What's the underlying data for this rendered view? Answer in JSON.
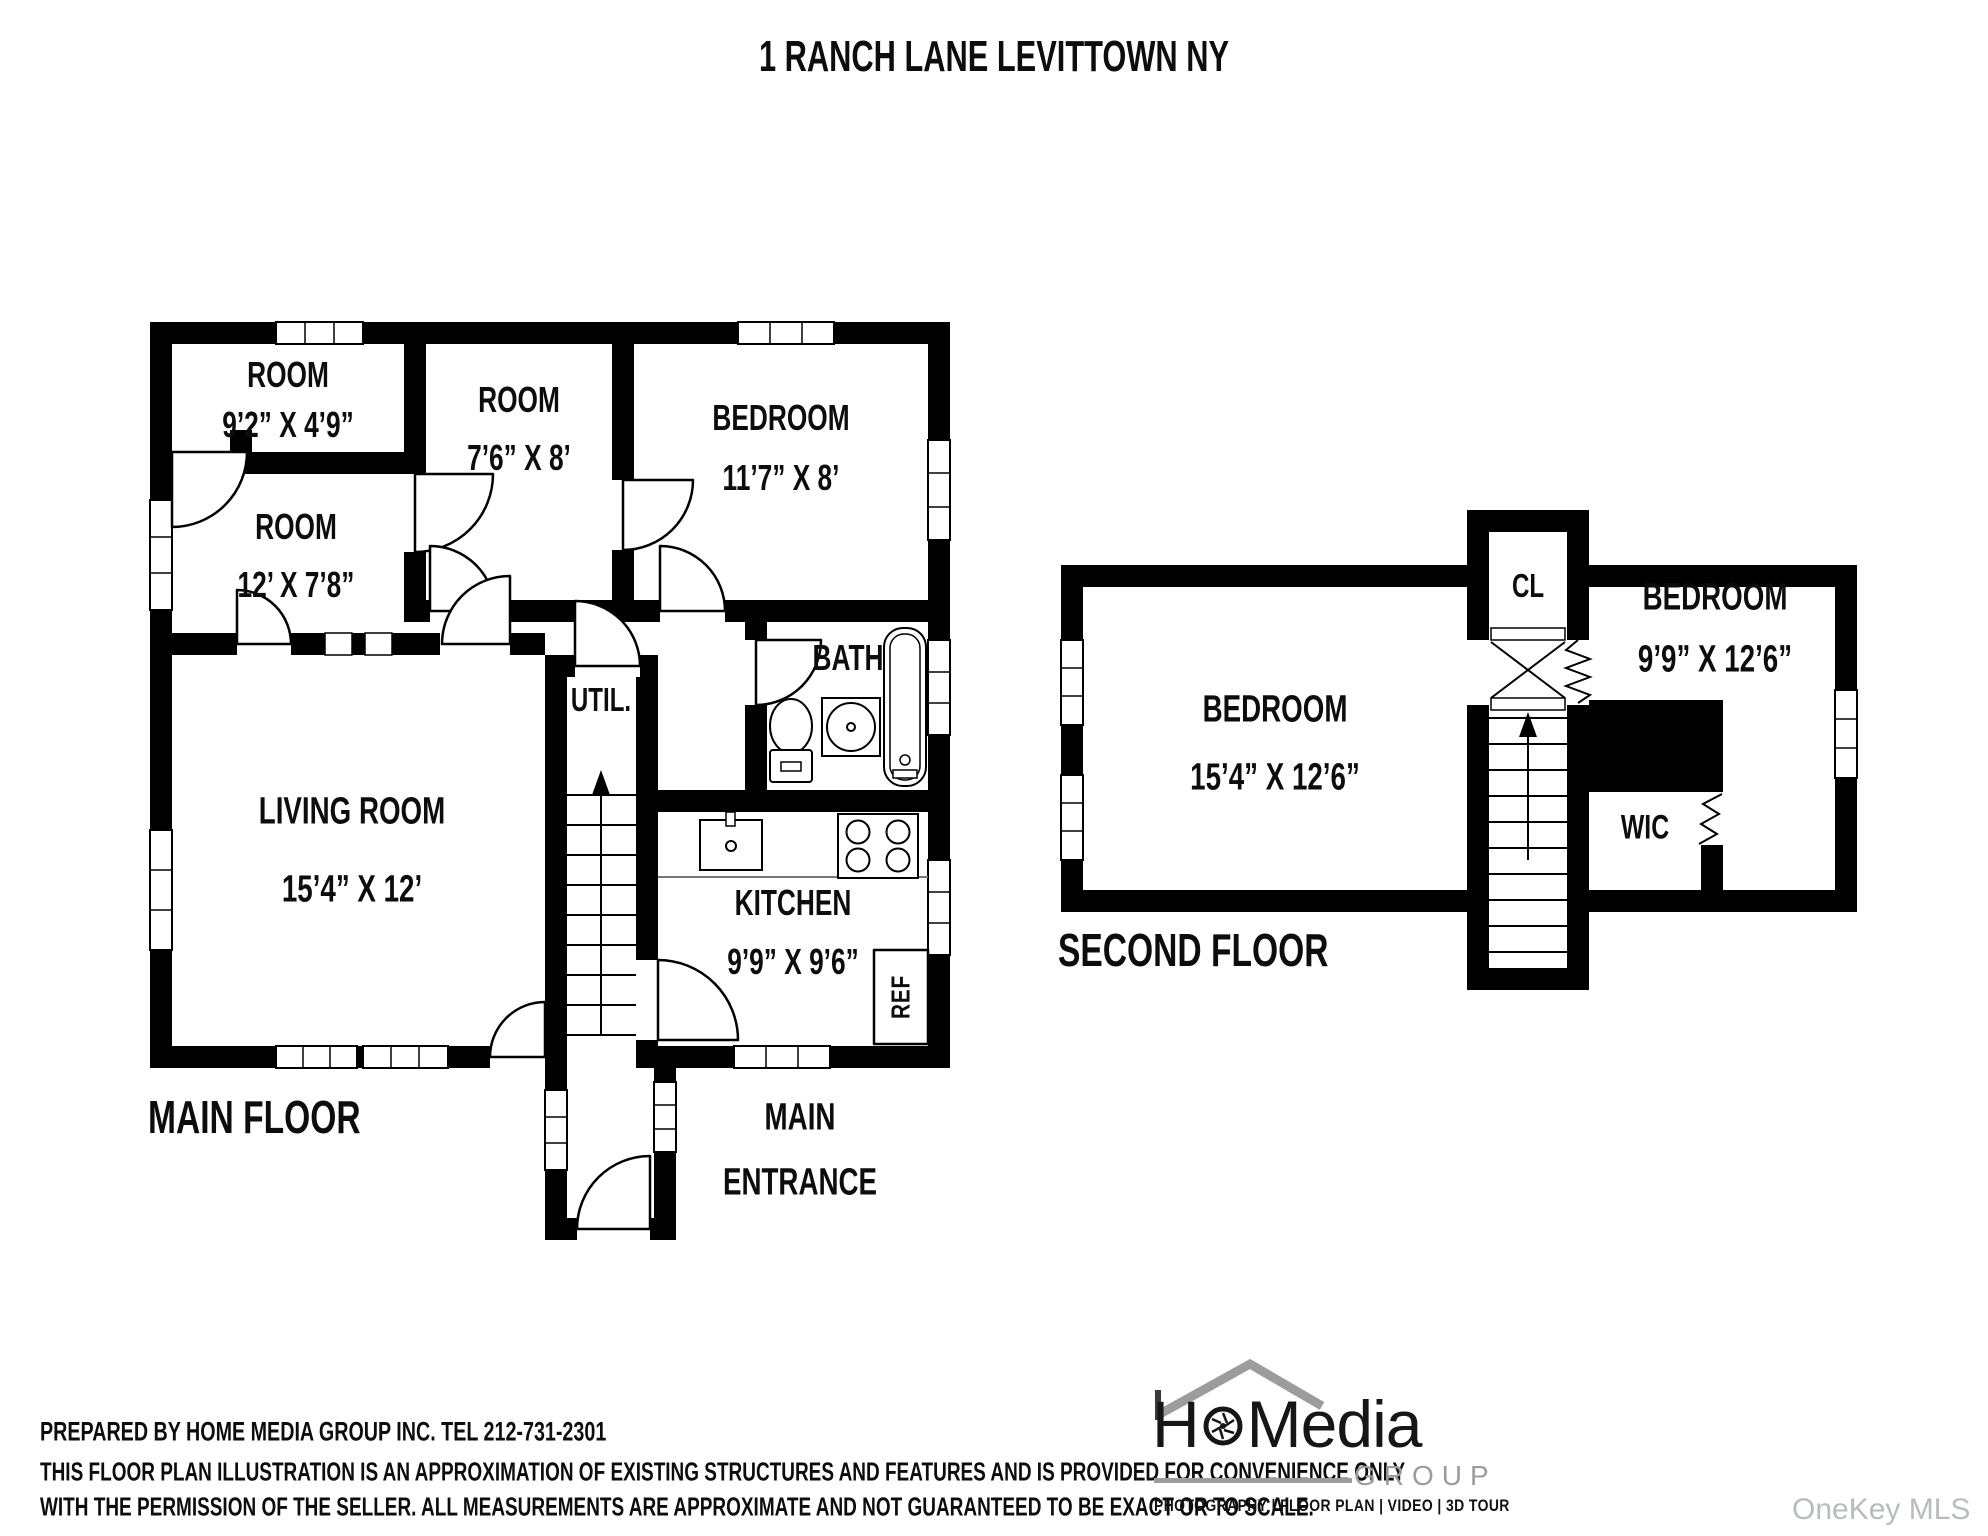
{
  "title": "1 RANCH LANE LEVITTOWN NY",
  "main_floor": {
    "floor_label": "MAIN FLOOR",
    "rooms": {
      "room1": {
        "name": "ROOM",
        "dims": "9’2” X 4’9”"
      },
      "room2": {
        "name": "ROOM",
        "dims": "7’6” X 8’"
      },
      "bedroom": {
        "name": "BEDROOM",
        "dims": "11’7” X 8’"
      },
      "room3": {
        "name": "ROOM",
        "dims": "12’ X 7’8”"
      },
      "bath": {
        "name": "BATH"
      },
      "util": {
        "name": "UTIL."
      },
      "living": {
        "name": "LIVING ROOM",
        "dims": "15’4” X 12’"
      },
      "kitchen": {
        "name": "KITCHEN",
        "dims": "9’9” X 9’6”"
      },
      "ref": {
        "name": "REF"
      },
      "entrance": {
        "line1": "MAIN",
        "line2": "ENTRANCE"
      }
    }
  },
  "second_floor": {
    "floor_label": "SECOND FLOOR",
    "rooms": {
      "bedroom1": {
        "name": "BEDROOM",
        "dims": "15’4” X 12’6”"
      },
      "bedroom2": {
        "name": "BEDROOM",
        "dims": "9’9” X 12’6”"
      },
      "cl": {
        "name": "CL"
      },
      "wic": {
        "name": "WIC"
      }
    }
  },
  "footer": {
    "prepared_by": "PREPARED BY  HOME MEDIA GROUP INC.  TEL 212-731-2301",
    "disclaimer1": "THIS FLOOR PLAN ILLUSTRATION IS AN APPROXIMATION OF EXISTING STRUCTURES AND FEATURES AND IS PROVIDED FOR CONVENIENCE ONLY",
    "disclaimer2": "WITH THE PERMISSION OF THE SELLER. ALL MEASUREMENTS ARE APPROXIMATE AND NOT GUARANTEED TO BE EXACT OR TO SCALE."
  },
  "logo": {
    "part_h": "H",
    "part_m": "M",
    "part_edia": "edia",
    "group": "GROUP",
    "tagline": "PHOTOGRAPHY | FLOOR PLAN | VIDEO | 3D TOUR"
  },
  "watermark": "OneKey MLS",
  "colors": {
    "wall": "#000000",
    "logo_gray": "#9c9c9c",
    "watermark_gray": "#b9bcbd"
  }
}
